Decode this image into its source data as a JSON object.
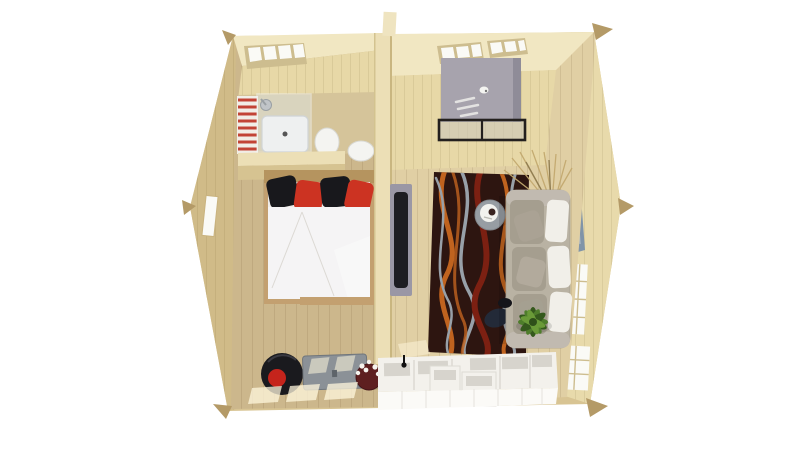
{
  "meta": {
    "app": "floor-plan-3d-render",
    "view": "top-down-cutaway",
    "canvas_width": 800,
    "canvas_height": 450,
    "rooms": [
      "bedroom",
      "bathroom",
      "living-room",
      "kitchen"
    ]
  },
  "colors": {
    "bg": "#ffffff",
    "exterior": "#d8c493",
    "exterior_dark": "#d0bb88",
    "wall_right": "#e8daab",
    "ceiling": "#f1e7c2",
    "wall_light": "#e7d8a7",
    "wall_top": "#ecdfb6",
    "wall_front": "#d6c391",
    "floor_left": "#ccb78c",
    "floor_right": "#e0cfa4",
    "floor_bath": "#d5c49a",
    "beam": "#b49a67",
    "window_white": "#fafaf6",
    "window_frame": "#cdbd8f",
    "radiator_red": "#c24335",
    "fixture_white": "#f4f4f1",
    "glass": "#dfe8ea",
    "bedframe": "#c3a070",
    "headboard": "#b5945f",
    "duvet_white": "#f5f4f5",
    "pillow_black": "#18181c",
    "pillow_red": "#cc3322",
    "tv_panel": "#9a97a5",
    "tv_screen": "#1d1d22",
    "partition_edge": "#c9b680",
    "rug_base": "#2d1510",
    "rug_orange": "#c0631f",
    "rug_red": "#7c2012",
    "rug_gray": "#98a0a8",
    "sofa_body": "#b9b2a3",
    "sofa_cushion": "#a59e8f",
    "sofa_white": "#f1efe9",
    "table_gray": "#979da3",
    "tray_white": "#f2f2ee",
    "coffee_dark": "#3a2420",
    "plant_green": "#4e7d2b",
    "plant_dark": "#35591d",
    "cabinet_gray": "#a7a3ad",
    "console_frame": "#23201e",
    "counter_white": "#f3f1ec",
    "counter_front": "#fbfaf7",
    "counter_inset": "#d7d4cd",
    "trunk_gray": "#8b9197",
    "vase_maroon": "#5e1f20",
    "ottoman_black": "#1a1a1e",
    "ottoman_red": "#c5241c",
    "art_red": "#a83226",
    "art_blue": "#8094a8",
    "branch_tan": "#c3a96f",
    "sunlight": "#fff7dd",
    "tap_black": "#111111"
  },
  "scene": {
    "bedroom_items": [
      "double-bed",
      "black-pillows",
      "red-pillows",
      "white-duvet",
      "round-ottoman",
      "storage-trunk",
      "flower-vase",
      "side-window"
    ],
    "bathroom_items": [
      "towel-radiator",
      "glass-shower",
      "shower-tray",
      "toilet",
      "wash-basin"
    ],
    "living_items": [
      "wall-tv",
      "patterned-rug",
      "side-table-coffee-tray",
      "sofa",
      "white-back-pillows",
      "gray-cushions",
      "potted-plant",
      "dark-floor-pillow",
      "wall-art",
      "tall-gray-cabinet",
      "black-frame-console",
      "dried-branches"
    ],
    "kitchen_items": [
      "counter-units",
      "raised-units",
      "black-tap"
    ],
    "shell_items": [
      "gable-peak-left",
      "gable-peak-right",
      "roof-beam-tips",
      "ceiling-windows",
      "wall-windows"
    ]
  }
}
